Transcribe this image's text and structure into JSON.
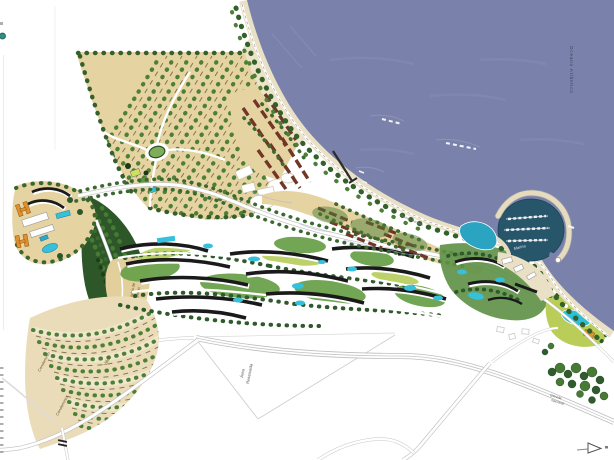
{
  "map": {
    "labels": {
      "ocean": "Oceano Atlântico",
      "nucleo_line1": "Núcleo de",
      "nucleo_line2": "Ensino",
      "villas": "Villas",
      "condominio_a": "Condomínio",
      "condominio_b": "Condomínio",
      "area_line1": "Área",
      "area_line2": "Reservada",
      "marina": "Marina",
      "promenade": "Passeio Marítimo",
      "road_line1": "Estrada",
      "road_line2": "Nacional"
    },
    "colors": {
      "sea": "#7a82ab",
      "marina_water": "#27566b",
      "sand": "#e9e0c5",
      "field_tan": "#e6d3a2",
      "field_light": "#eadcb8",
      "forest_dark": "#2d5729",
      "tree_green": "#4e7f37",
      "lawn": "#b9cd58",
      "building_dark": "#1a1a1a",
      "building_maroon": "#713626",
      "building_orange": "#e0912f",
      "pool_cyan": "#35c0dc",
      "road_gray": "#bdbdbd",
      "page": "#ffffff"
    }
  }
}
